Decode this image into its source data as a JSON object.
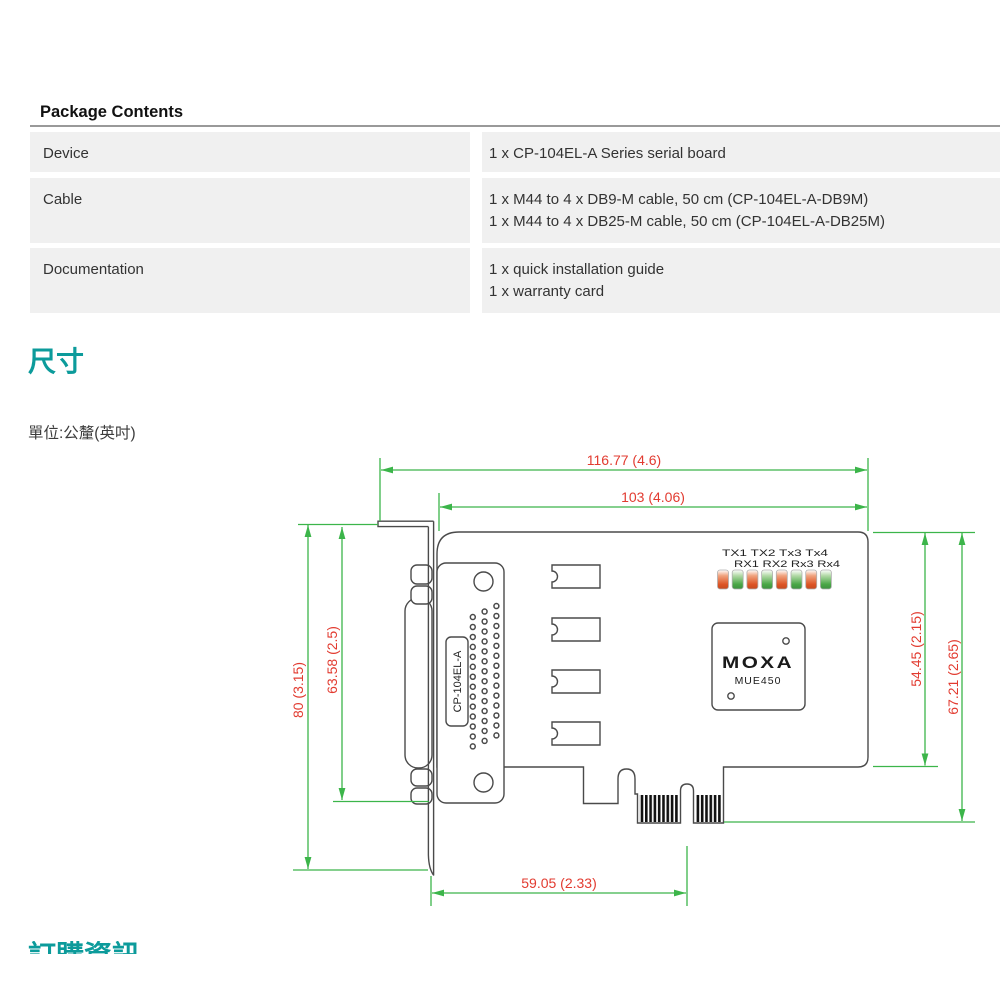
{
  "package_contents": {
    "title": "Package Contents",
    "rows": [
      {
        "label": "Device",
        "items": [
          "1 x CP-104EL-A Series serial board"
        ]
      },
      {
        "label": "Cable",
        "items": [
          "1 x M44 to 4 x DB9-M cable, 50 cm (CP-104EL-A-DB9M)",
          "1 x M44 to 4 x DB25-M cable, 50 cm (CP-104EL-A-DB25M)"
        ]
      },
      {
        "label": "Documentation",
        "items": [
          "1 x quick installation guide",
          "1 x warranty card"
        ]
      }
    ]
  },
  "dimensions": {
    "heading": "尺寸",
    "unit_note": "單位:公釐(英吋)"
  },
  "diagram": {
    "dimension_labels": {
      "overall_width": "116.77 (4.6)",
      "board_width": "103 (4.06)",
      "bracket_height": "80 (3.15)",
      "connector_height": "63.58 (2.5)",
      "board_height": "54.45 (2.15)",
      "board_height_with_connector": "67.21 (2.65)",
      "bracket_to_pcie_key": "59.05 (2.33)"
    },
    "board_labels": {
      "connector_model": "CP-104EL-A",
      "led_labels_top": "TX1 TX2 Tx3 Tx4",
      "led_labels_bottom": "RX1 RX2 Rx3 Rx4",
      "chip_brand": "MOXA",
      "chip_model": "MUE450"
    },
    "colors": {
      "dimension_line": "#3cb54a",
      "dimension_text": "#e23b30",
      "outline": "#4a4a4a",
      "led_red": "#dd5526",
      "led_green": "#4aa747",
      "heading_teal": "#0c9b9b",
      "table_row_bg": "#f0f0f0"
    }
  },
  "next_section": {
    "heading": "訂購資訊"
  }
}
